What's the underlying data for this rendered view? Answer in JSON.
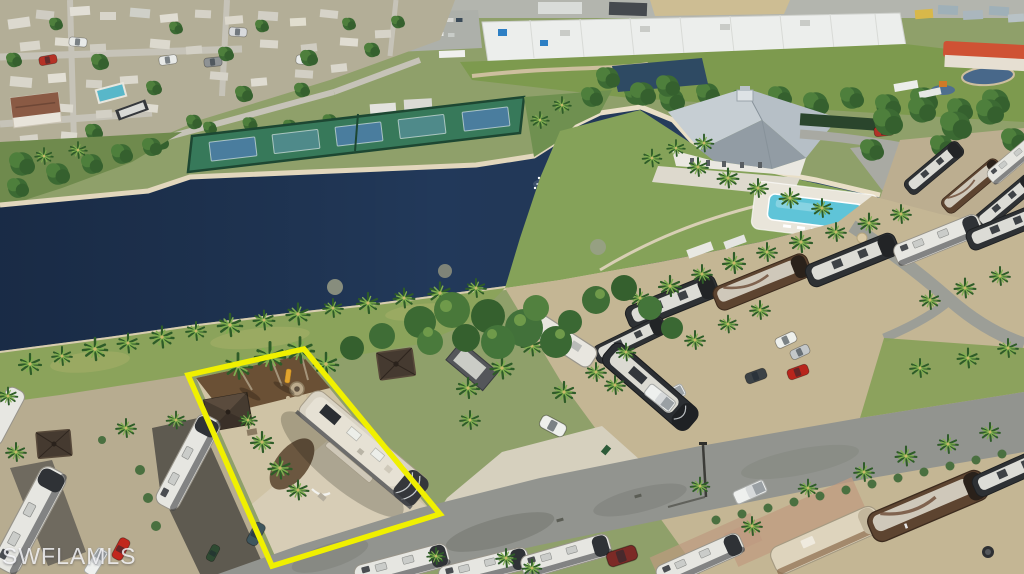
{
  "watermark": {
    "text": "SWFLAMLS"
  },
  "colors": {
    "highlight_outline": "#F0F000",
    "lake_water": "#22395A",
    "pool_water": "#5FC4D8",
    "court_green": "#37795A",
    "court_blue": "#4A7D9E",
    "court_teal": "#4F8A8A",
    "grass_bank": "#8BA35B",
    "clubhouse_lawn": "#85A259",
    "asphalt_road": "#92948F",
    "warehouse_roof": "#ECEEEC",
    "clubhouse_roof": "#B6BFC6",
    "featured_rv_roof": "#D9D3C4",
    "pavilion_roof": "#463B30",
    "shoreline_rock": "#E2D7BD",
    "mulch": "#6A5035",
    "paver_tan": "#CFC3A5"
  }
}
